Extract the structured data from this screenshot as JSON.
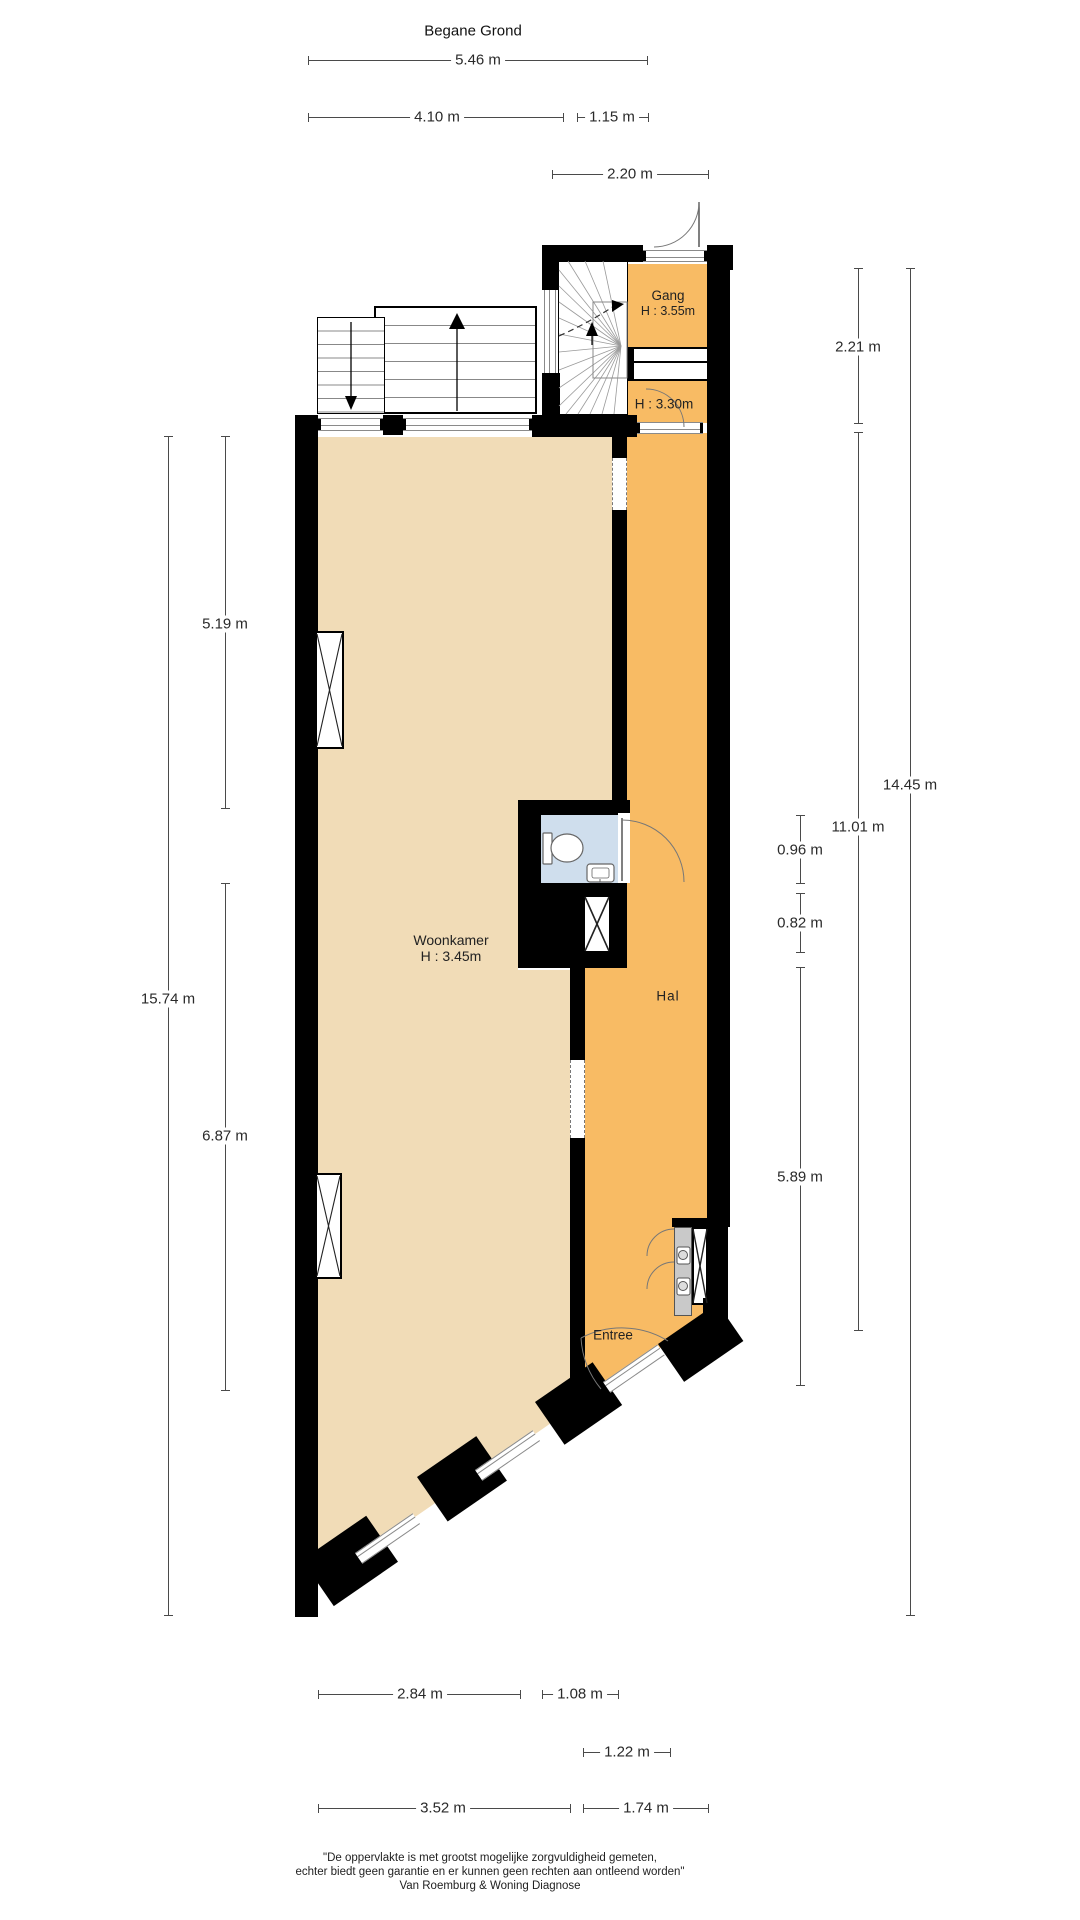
{
  "title": "Begane Grond",
  "rooms": {
    "gang": {
      "name": "Gang",
      "height": "H : 3.55m"
    },
    "tussen": {
      "height": "H : 3.30m"
    },
    "woonkamer": {
      "name": "Woonkamer",
      "height": "H : 3.45m"
    },
    "hal": {
      "name": "Hal"
    },
    "entree": {
      "name": "Entree"
    }
  },
  "dims": {
    "top": [
      {
        "label": "5.46 m"
      },
      {
        "label": "4.10 m"
      },
      {
        "label": "1.15 m"
      },
      {
        "label": "2.20 m"
      }
    ],
    "left": [
      {
        "label": "15.74 m"
      },
      {
        "label": "5.19 m"
      },
      {
        "label": "6.87 m"
      }
    ],
    "right": [
      {
        "label": "2.21 m"
      },
      {
        "label": "11.01 m"
      },
      {
        "label": "14.45 m"
      },
      {
        "label": "0.96 m"
      },
      {
        "label": "0.82 m"
      },
      {
        "label": "5.89 m"
      }
    ],
    "bottom": [
      {
        "label": "2.84 m"
      },
      {
        "label": "1.08 m"
      },
      {
        "label": "1.22 m"
      },
      {
        "label": "3.52 m"
      },
      {
        "label": "1.74 m"
      }
    ]
  },
  "footer": {
    "line1": "\"De oppervlakte is met grootst mogelijke zorgvuldigheid gemeten,",
    "line2": "echter biedt geen garantie en er kunnen geen rechten aan ontleend worden\"",
    "line3": "Van Roemburg & Woning Diagnose"
  },
  "colors": {
    "wall": "#000000",
    "woonkamer_floor": "#f1dcb7",
    "hal_floor": "#f8bb64",
    "toilet_floor": "#cfdeed",
    "counter": "#c9c9c9"
  }
}
